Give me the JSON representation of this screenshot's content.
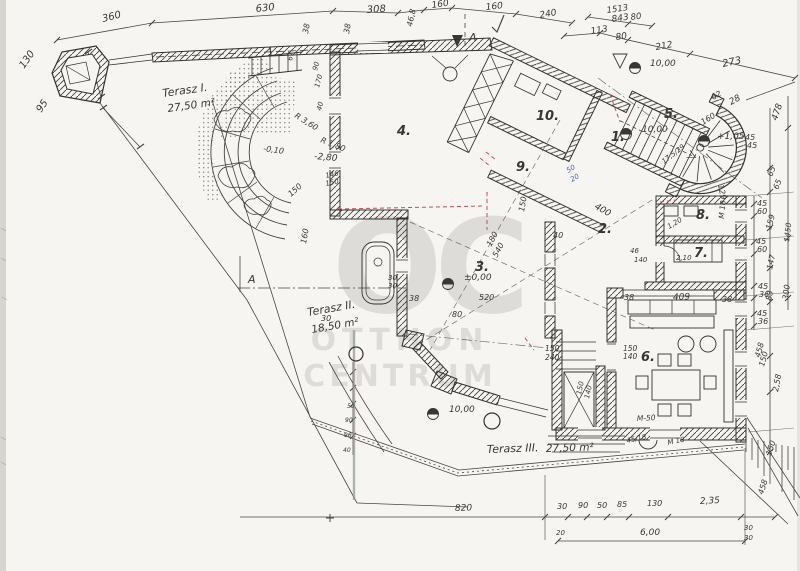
{
  "document": {
    "type": "hand-drawn architectural floor plan (scanned)",
    "watermark": {
      "monogram": "OC",
      "line1": "OTTHON",
      "line2": "CENTRUM"
    }
  },
  "colors": {
    "paper": "#f6f5f1",
    "ink": "#3a3733",
    "accent_red": "#c44f5f",
    "accent_blue": "#4a5fae",
    "watermark": "#c7c5c1",
    "scan_bar": "#8f959e"
  },
  "rooms": [
    {
      "n": "1.",
      "x": 611,
      "y": 141
    },
    {
      "n": "2.",
      "x": 598,
      "y": 233
    },
    {
      "n": "3.",
      "x": 475,
      "y": 271
    },
    {
      "n": "4.",
      "x": 397,
      "y": 135
    },
    {
      "n": "5.",
      "x": 664,
      "y": 118
    },
    {
      "n": "6.",
      "x": 641,
      "y": 361
    },
    {
      "n": "7.",
      "x": 694,
      "y": 257
    },
    {
      "n": "8.",
      "x": 696,
      "y": 219
    },
    {
      "n": "9.",
      "x": 516,
      "y": 171
    },
    {
      "n": "10.",
      "x": 536,
      "y": 120
    }
  ],
  "terraces": [
    {
      "name": "Terasz I.",
      "area": "27,50 m²",
      "x": 163,
      "y": 97,
      "x2": 168,
      "y2": 112,
      "r": -8
    },
    {
      "name": "Terasz II.",
      "area": "18,50 m²",
      "x": 308,
      "y": 316,
      "x2": 312,
      "y2": 333,
      "r": -10
    },
    {
      "name": "Terasz III.",
      "area": "27,50 m²",
      "x": 487,
      "y": 453,
      "x2": 546,
      "y2": 452,
      "r": -2
    }
  ],
  "levels": [
    {
      "label": "±0,00",
      "x": 464,
      "y": 280,
      "mx": 448,
      "my": 284
    },
    {
      "label": "10,00",
      "x": 650,
      "y": 66,
      "mx": 635,
      "my": 68,
      "tri": true,
      "tx": 620,
      "ty": 62
    },
    {
      "label": "10,00",
      "x": 449,
      "y": 412,
      "mx": 433,
      "my": 414
    },
    {
      "label": "10,00",
      "x": 642,
      "y": 132,
      "mx": 626,
      "my": 134
    },
    {
      "label": "+1,05",
      "x": 717,
      "y": 139,
      "mx": 704,
      "my": 141
    }
  ],
  "annotations": [
    {
      "t": "360",
      "x": 103,
      "y": 22,
      "r": -14,
      "s": 10
    },
    {
      "t": "630",
      "x": 256,
      "y": 12,
      "r": -6,
      "s": 10
    },
    {
      "t": "308",
      "x": 367,
      "y": 13,
      "r": -4,
      "s": 10
    },
    {
      "t": "160",
      "x": 432,
      "y": 8,
      "r": -8,
      "s": 9
    },
    {
      "t": "160",
      "x": 486,
      "y": 10,
      "r": -6,
      "s": 9
    },
    {
      "t": "240",
      "x": 540,
      "y": 18,
      "r": -10,
      "s": 9
    },
    {
      "t": "46,8",
      "x": 412,
      "y": 27,
      "r": -78,
      "s": 8
    },
    {
      "t": "1513",
      "x": 607,
      "y": 13,
      "r": -8,
      "s": 8.5
    },
    {
      "t": "80",
      "x": 631,
      "y": 20,
      "r": -8,
      "s": 8.5
    },
    {
      "t": "843",
      "x": 612,
      "y": 22,
      "r": -8,
      "s": 9
    },
    {
      "t": "113",
      "x": 591,
      "y": 34,
      "r": -8,
      "s": 9
    },
    {
      "t": "80",
      "x": 616,
      "y": 40,
      "r": -8,
      "s": 9
    },
    {
      "t": "212",
      "x": 656,
      "y": 50,
      "r": -10,
      "s": 9
    },
    {
      "t": "273",
      "x": 723,
      "y": 67,
      "r": -12,
      "s": 10
    },
    {
      "t": "130",
      "x": 24,
      "y": 69,
      "r": -55,
      "s": 10
    },
    {
      "t": "95",
      "x": 41,
      "y": 113,
      "r": -55,
      "s": 10
    },
    {
      "t": "R 3,60",
      "x": 294,
      "y": 117,
      "r": 32,
      "s": 8
    },
    {
      "t": "R 1,80",
      "x": 320,
      "y": 142,
      "r": 22,
      "s": 8
    },
    {
      "t": "-2,80",
      "x": 314,
      "y": 159,
      "r": 5,
      "s": 9
    },
    {
      "t": "-0,10",
      "x": 263,
      "y": 151,
      "r": 8,
      "s": 8
    },
    {
      "t": "146",
      "x": 326,
      "y": 178,
      "r": -12,
      "s": 7
    },
    {
      "t": "150",
      "x": 326,
      "y": 186,
      "r": -12,
      "s": 7
    },
    {
      "t": "150",
      "x": 291,
      "y": 197,
      "r": -42,
      "s": 8
    },
    {
      "t": "160",
      "x": 306,
      "y": 244,
      "r": -80,
      "s": 8
    },
    {
      "t": "90",
      "x": 317,
      "y": 71,
      "r": -75,
      "s": 7
    },
    {
      "t": "170",
      "x": 319,
      "y": 88,
      "r": -75,
      "s": 7
    },
    {
      "t": "40",
      "x": 321,
      "y": 111,
      "r": -75,
      "s": 7
    },
    {
      "t": "38",
      "x": 308,
      "y": 34,
      "r": -80,
      "s": 8
    },
    {
      "t": "38",
      "x": 349,
      "y": 34,
      "r": -80,
      "s": 8
    },
    {
      "t": "67",
      "x": 292,
      "y": 61,
      "r": -80,
      "s": 7
    },
    {
      "t": "400",
      "x": 594,
      "y": 208,
      "r": 30,
      "s": 9
    },
    {
      "t": "150",
      "x": 524,
      "y": 212,
      "r": -80,
      "s": 8
    },
    {
      "t": "540",
      "x": 497,
      "y": 258,
      "r": -62,
      "s": 8
    },
    {
      "t": "180",
      "x": 491,
      "y": 247,
      "r": -62,
      "s": 8
    },
    {
      "t": "40",
      "x": 553,
      "y": 238,
      "s": 8
    },
    {
      "t": "46",
      "x": 630,
      "y": 253,
      "s": 7
    },
    {
      "t": "140",
      "x": 634,
      "y": 262,
      "s": 7
    },
    {
      "t": "30",
      "x": 388,
      "y": 280,
      "s": 7
    },
    {
      "t": "30",
      "x": 388,
      "y": 288,
      "s": 7
    },
    {
      "t": "38",
      "x": 409,
      "y": 301,
      "s": 8
    },
    {
      "t": "80",
      "x": 452,
      "y": 317,
      "s": 8
    },
    {
      "t": "520",
      "x": 479,
      "y": 300,
      "s": 8
    },
    {
      "t": "30",
      "x": 321,
      "y": 321,
      "s": 8
    },
    {
      "t": "28",
      "x": 731,
      "y": 105,
      "r": -28,
      "s": 9
    },
    {
      "t": "62",
      "x": 713,
      "y": 100,
      "r": -28,
      "s": 8
    },
    {
      "t": "160",
      "x": 703,
      "y": 125,
      "r": -32,
      "s": 8
    },
    {
      "t": "45",
      "x": 745,
      "y": 140,
      "s": 8
    },
    {
      "t": "45",
      "x": 747,
      "y": 148,
      "s": 8
    },
    {
      "t": "478",
      "x": 777,
      "y": 121,
      "r": -72,
      "s": 9
    },
    {
      "t": "129",
      "x": 718,
      "y": 185,
      "r": 78,
      "s": 8
    },
    {
      "t": "17,5/29",
      "x": 664,
      "y": 164,
      "r": -38,
      "s": 7
    },
    {
      "t": "M 18",
      "x": 724,
      "y": 219,
      "r": -85,
      "s": 7.5
    },
    {
      "t": "1,20",
      "x": 669,
      "y": 229,
      "r": -30,
      "s": 7
    },
    {
      "t": "2,10",
      "x": 676,
      "y": 260,
      "s": 7
    },
    {
      "t": "65",
      "x": 772,
      "y": 177,
      "r": -68,
      "s": 8
    },
    {
      "t": "65",
      "x": 778,
      "y": 190,
      "r": -68,
      "s": 8
    },
    {
      "t": "45",
      "x": 757,
      "y": 206,
      "s": 8
    },
    {
      "t": "60",
      "x": 757,
      "y": 214,
      "s": 8
    },
    {
      "t": "159",
      "x": 771,
      "y": 230,
      "r": -75,
      "s": 8
    },
    {
      "t": "1450",
      "x": 789,
      "y": 242,
      "r": -83,
      "s": 7.5
    },
    {
      "t": "45",
      "x": 756,
      "y": 244,
      "s": 8
    },
    {
      "t": "60",
      "x": 757,
      "y": 252,
      "s": 8
    },
    {
      "t": "147",
      "x": 772,
      "y": 270,
      "r": -78,
      "s": 8
    },
    {
      "t": "45",
      "x": 758,
      "y": 289,
      "s": 8
    },
    {
      "t": "36",
      "x": 759,
      "y": 297,
      "s": 8
    },
    {
      "t": "83",
      "x": 771,
      "y": 301,
      "r": -78,
      "s": 8
    },
    {
      "t": "300",
      "x": 788,
      "y": 300,
      "r": -83,
      "s": 8
    },
    {
      "t": "45",
      "x": 757,
      "y": 316,
      "s": 8
    },
    {
      "t": "36",
      "x": 758,
      "y": 324,
      "s": 8
    },
    {
      "t": "458",
      "x": 760,
      "y": 358,
      "r": -75,
      "s": 8
    },
    {
      "t": "150",
      "x": 764,
      "y": 367,
      "r": -75,
      "s": 8
    },
    {
      "t": "2,58",
      "x": 778,
      "y": 392,
      "r": -80,
      "s": 8
    },
    {
      "t": "150",
      "x": 771,
      "y": 456,
      "r": -72,
      "s": 8
    },
    {
      "t": "458",
      "x": 763,
      "y": 495,
      "r": -72,
      "s": 8
    },
    {
      "t": "409",
      "x": 673,
      "y": 300,
      "r": -2,
      "s": 9
    },
    {
      "t": "38",
      "x": 624,
      "y": 300,
      "s": 8
    },
    {
      "t": "38",
      "x": 722,
      "y": 302,
      "s": 8
    },
    {
      "t": "150",
      "x": 545,
      "y": 351,
      "s": 7.5
    },
    {
      "t": "240",
      "x": 545,
      "y": 360,
      "s": 7.5
    },
    {
      "t": "150",
      "x": 623,
      "y": 351,
      "s": 7.5
    },
    {
      "t": "140",
      "x": 623,
      "y": 359,
      "s": 7.5
    },
    {
      "t": "150",
      "x": 581,
      "y": 395,
      "r": -78,
      "s": 7
    },
    {
      "t": "140",
      "x": 589,
      "y": 399,
      "r": -78,
      "s": 7
    },
    {
      "t": "45/18",
      "x": 627,
      "y": 443,
      "r": -12,
      "s": 7
    },
    {
      "t": "M 18",
      "x": 668,
      "y": 445,
      "r": -12,
      "s": 7
    },
    {
      "t": "M-50",
      "x": 637,
      "y": 421,
      "r": -3,
      "s": 7.5
    },
    {
      "t": "820",
      "x": 455,
      "y": 511,
      "r": -2,
      "s": 9
    },
    {
      "t": "30",
      "x": 557,
      "y": 509,
      "s": 8
    },
    {
      "t": "90",
      "x": 578,
      "y": 508,
      "s": 8
    },
    {
      "t": "50",
      "x": 597,
      "y": 508,
      "s": 8
    },
    {
      "t": "85",
      "x": 617,
      "y": 507,
      "s": 8
    },
    {
      "t": "130",
      "x": 647,
      "y": 506,
      "s": 8
    },
    {
      "t": "2,35",
      "x": 700,
      "y": 504,
      "r": -3,
      "s": 9
    },
    {
      "t": "6,00",
      "x": 640,
      "y": 535,
      "s": 9
    },
    {
      "t": "30",
      "x": 744,
      "y": 530,
      "s": 7
    },
    {
      "t": "30",
      "x": 744,
      "y": 540,
      "s": 7
    },
    {
      "t": "20",
      "x": 556,
      "y": 535,
      "s": 7
    },
    {
      "t": "50",
      "x": 347,
      "y": 408,
      "s": 6
    },
    {
      "t": "90",
      "x": 345,
      "y": 422,
      "s": 6
    },
    {
      "t": "90",
      "x": 344,
      "y": 437,
      "s": 6
    },
    {
      "t": "40",
      "x": 343,
      "y": 452,
      "s": 6
    },
    {
      "t": "A",
      "x": 248,
      "y": 283,
      "s": 11
    },
    {
      "t": "A",
      "x": 469,
      "y": 41,
      "s": 11
    },
    {
      "t": "50",
      "x": 568,
      "y": 173,
      "r": -30,
      "s": 7,
      "c": "blue"
    },
    {
      "t": "20",
      "x": 572,
      "y": 182,
      "r": -30,
      "s": 7,
      "c": "blue"
    }
  ]
}
